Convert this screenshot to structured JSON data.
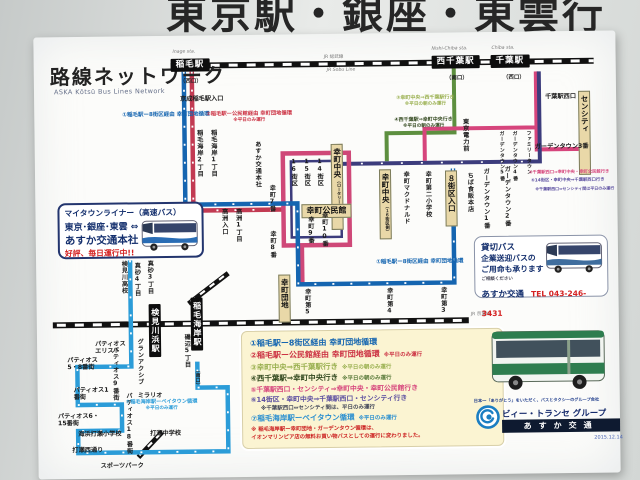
{
  "photo": {
    "wall_heading": "東京駅・銀座・東雲行"
  },
  "poster": {
    "title": "路線ネットワーク",
    "subtitle": "ASKA Kōtsū Bus Lines Network"
  },
  "rail": {
    "sobu_ja": "JR 総武線",
    "sobu_en": "JR Sobu Line",
    "keiyo_ja": "JR 京葉線"
  },
  "stations": {
    "inage": "稲毛駅",
    "inage_exit": "（西口）",
    "inage_en": "Inage sta.",
    "nishichiba": "西千葉駅",
    "nishichiba_exit": "（南口）",
    "nishichiba_en": "Nishi-Chiba sta.",
    "chiba": "千葉駅",
    "chiba_exit": "（西口）",
    "chiba_en": "Chiba sta.",
    "kemigawahama": "検見川浜駅",
    "inagekaigan": "稲毛海岸駅",
    "inagekaigan_exit": "（南口）"
  },
  "boxes": {
    "chuo_rotary": "幸町中央",
    "chuo_rotary_sub": "（ロータリー側）",
    "kominkan": "幸町公民館",
    "chuo2": "幸町中央",
    "chuo2_sub": "（１６街区側）",
    "hachigaiku_iriguchi": "８街区入口",
    "saiwai_danchi": "幸町団地",
    "sencity": "センシティ",
    "chiba_nishiguchi": "千葉駅西口"
  },
  "stops": [
    "京成稲毛駅入口",
    "稲毛海岸2丁目",
    "稲毛海岸1丁目",
    "あすか交通本社",
    "16街区",
    "15街区",
    "14街区",
    "幸町7番",
    "幸町8番",
    "幸町9番",
    "幸町10番",
    "高洲入口",
    "高洲1丁目",
    "幸町第5",
    "幸町第4",
    "幸町第3",
    "幸町マクドナルド",
    "幸町第二小学校",
    "ちば食販本店",
    "ガーデンタウン1番",
    "ガーデンタウン2番",
    "ガーデンタウン5番",
    "ガーデンタウン4番",
    "ファミリータウン",
    "東京電力前",
    "ガーデンタウン3番",
    "検見川高校",
    "真砂4丁目",
    "真砂3丁目",
    "パティオスエリスト",
    "パティオス5・8番街",
    "パティオス1番街",
    "パティオス6・15番街",
    "パティオス9番街",
    "パティオス18番街",
    "グランアクシブ",
    "ミラリオ",
    "磯辺5丁目",
    "海浜打瀬小学校",
    "打瀬西通り",
    "スポーツパーク",
    "打瀬中学校"
  ],
  "map_notes": {
    "r1_left": "①稲毛駅ー8街区経由 幸町団地循環",
    "r2_l1": "②稲毛駅ー公民館経由 幸町団地循環",
    "r2_l2": "※平日のみ運行",
    "r3_l1": "③幸町中央⇒西千葉駅行き",
    "r3_l2": "※平日の朝のみ運行",
    "r4_l1": "④西千葉駅⇒幸町中央行き",
    "r4_l2": "※平日の朝のみ運行",
    "r5": "⑤千葉駅西口⇒幸町中央・幸町公民館行き",
    "r6": "⑥14街区・幸町中央⇒千葉駅西口行き",
    "r6_sub": "※千葉駅西口⇔センシティ間は平日のみ運行",
    "r1_right": "①稲毛駅ー8街区経由 幸町団地循環",
    "r7_l1": "⑦稲毛海岸駅ーベイタウン循環",
    "r7_l2": "※平日のみ運行"
  },
  "legend": {
    "rows": [
      {
        "text": "①稲毛駅ー8街区経由 幸町団地循環",
        "note": ""
      },
      {
        "text": "②稲毛駅ー公民館経由 幸町団地循環",
        "note": "※平日のみ運行"
      },
      {
        "text": "③幸町中央⇒西千葉駅行き",
        "note": "※平日の朝のみ運行"
      },
      {
        "text": "④西千葉駅⇒幸町中央行き",
        "note": "※平日の朝のみ運行"
      },
      {
        "text": "⑤千葉駅西口・センシティ⇒幸町中央・幸町公民館行き",
        "note": ""
      },
      {
        "text": "⑥14街区・幸町中央⇒千葉駅西口・センシティ行き",
        "note": ""
      },
      {
        "text": "※千葉駅西口⇔センシティ間は、平日のみ運行",
        "note": ""
      },
      {
        "text": "⑦稲毛海岸駅ーベイタウン循環",
        "note": "※平日のみ運行"
      }
    ],
    "foot1": "※ 稲毛海岸駅ー幸町団地・ガーデンタウン循環は、",
    "foot2": "イオンマリンピア店の無料お買い物バスとしての運行に変わりました。"
  },
  "mytown": {
    "l1": "マイタウンライナー（高速バス）",
    "l2": "東京･銀座･東雲 ⇔",
    "l3": "あすか交通本社",
    "l4": "好評、毎日運行中!!"
  },
  "charter": {
    "l1": "貸切バス",
    "l2": "企業送迎バスの",
    "l3": "ご用命も承ります",
    "l4": "ご相談ください",
    "l5": "あすか交通",
    "tel": "TEL 043-246-3431"
  },
  "footer": {
    "slogan": "日本一「ありがとう」をいただく、バスとタクシーのグループ会社",
    "group": "ビィー・トランセ グループ",
    "company": "あすか交通",
    "date": "2015.12.14"
  },
  "colors": {
    "blue": "#1565b0",
    "red": "#c23a52",
    "magenta": "#cf4878",
    "navy": "#3c3c7c",
    "green": "#5d8f3f",
    "pink": "#d6457c",
    "purple": "#5b4ea0",
    "light_blue": "#2b9cd8"
  }
}
